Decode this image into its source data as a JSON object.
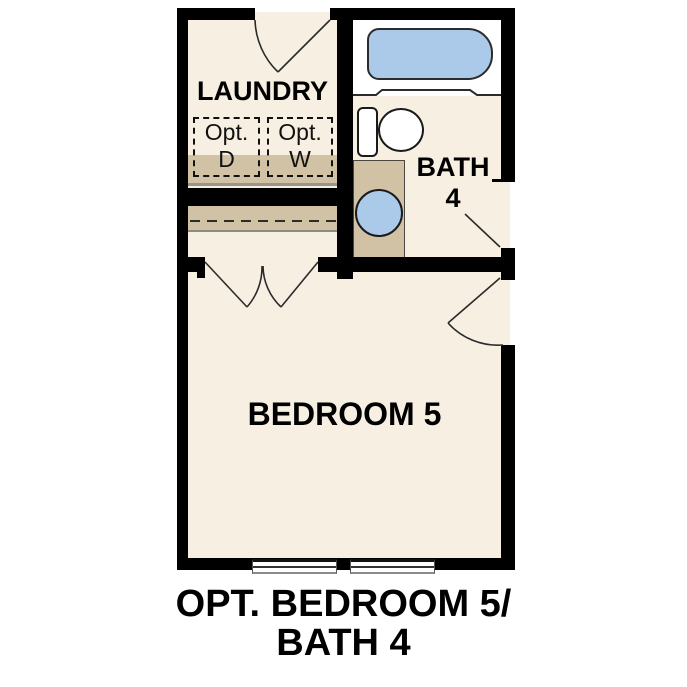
{
  "plan": {
    "rooms": {
      "laundry": {
        "label": "LAUNDRY"
      },
      "bath": {
        "name": "BATH",
        "number": "4"
      },
      "bedroom": {
        "label": "BEDROOM 5"
      }
    },
    "appliances": {
      "dryer": {
        "prefix": "Opt.",
        "letter": "D"
      },
      "washer": {
        "prefix": "Opt.",
        "letter": "W"
      }
    }
  },
  "caption": {
    "line1": "OPT. BEDROOM 5/",
    "line2": "BATH 4"
  },
  "colors": {
    "wall": "#000000",
    "floor": "#f7efe2",
    "fixture_blue": "#abcaea",
    "counter_tan": "#d1c2a5",
    "appliance_gray": "#dcdcdc",
    "background": "#ffffff"
  }
}
